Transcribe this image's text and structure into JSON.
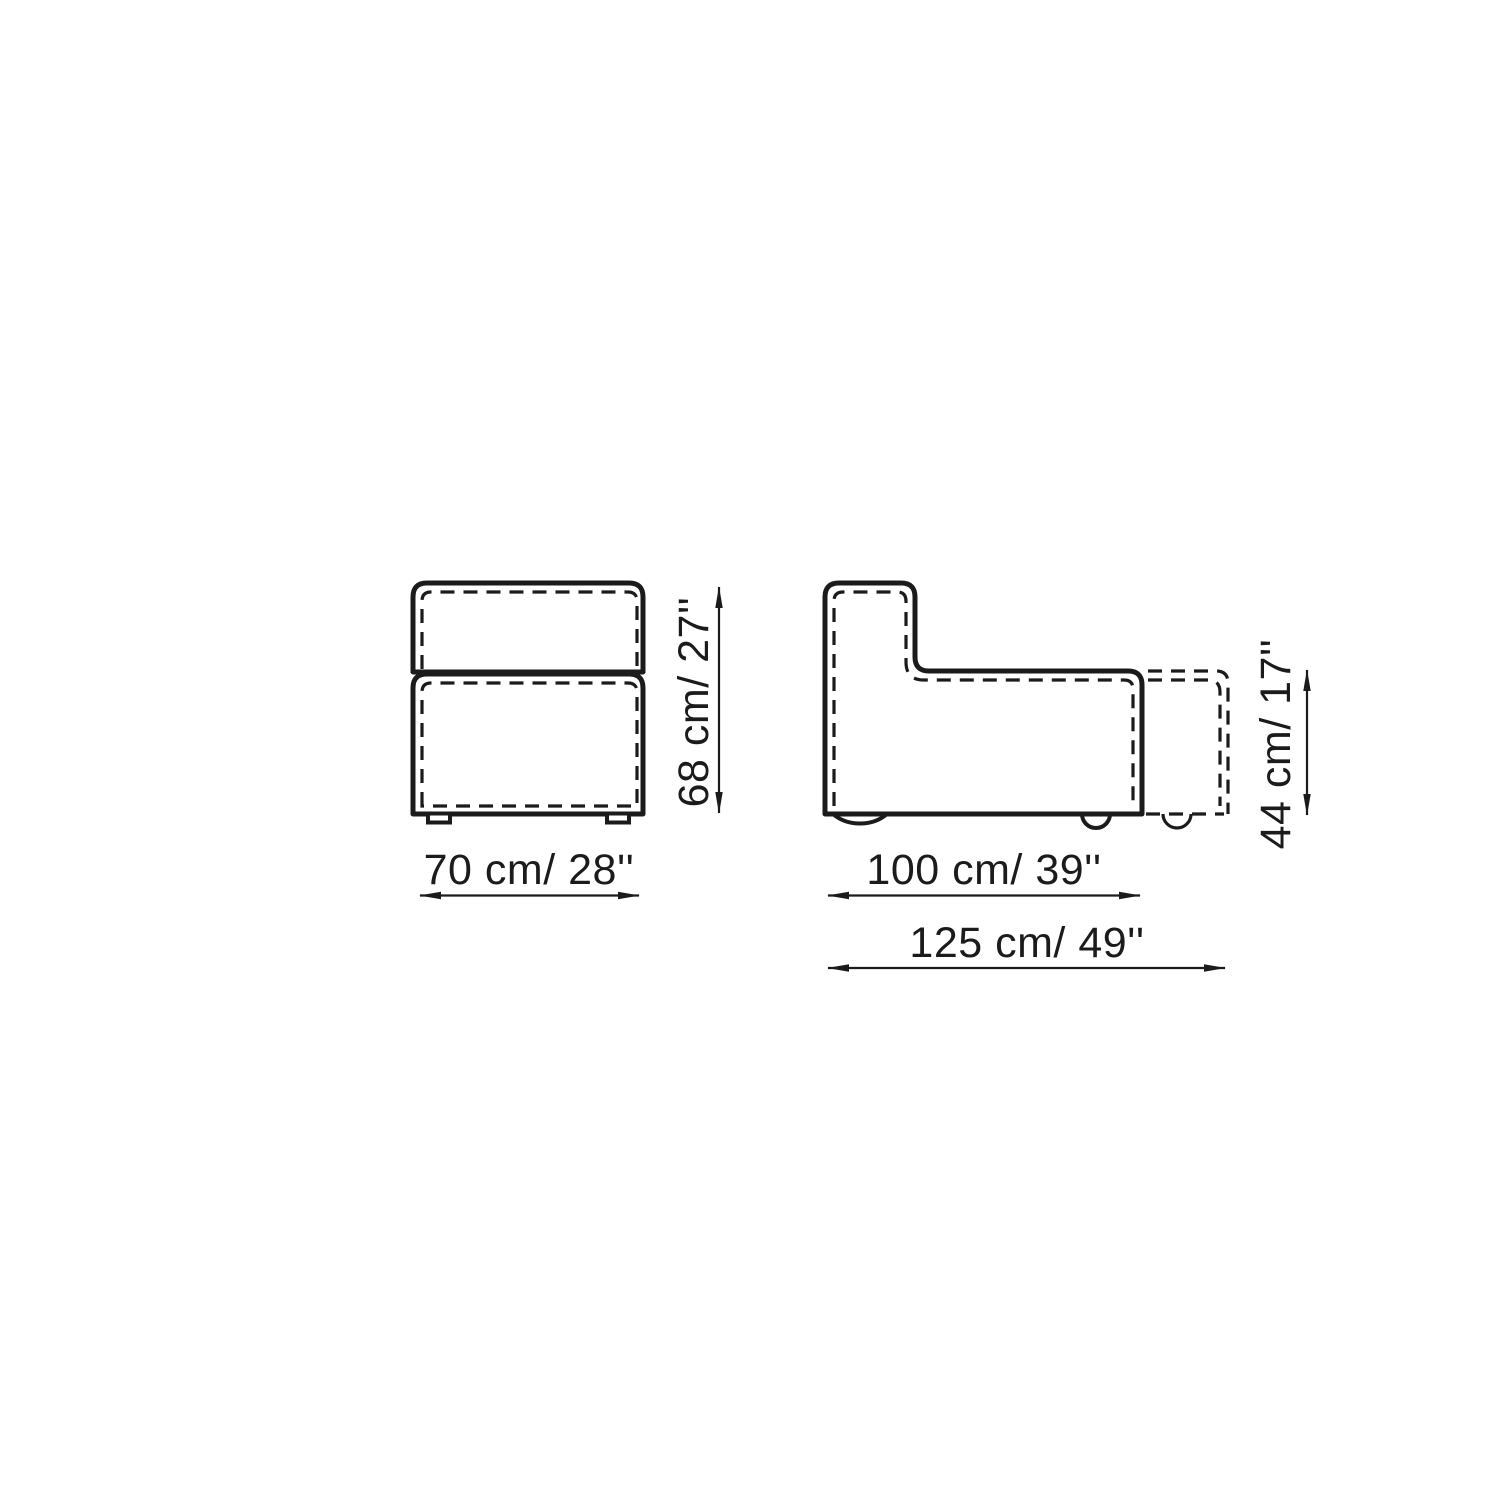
{
  "colors": {
    "line": "#1b1b1b",
    "background": "#ffffff"
  },
  "drawing": {
    "type": "furniture-dimension-drawing",
    "views": [
      "front",
      "side"
    ]
  },
  "dims": {
    "front_width": "70 cm/ 28''",
    "front_height": "68 cm/ 27''",
    "side_seat_depth": "100 cm/ 39''",
    "side_overall_depth": "125 cm/ 49''",
    "side_seat_height": "44 cm/ 17''"
  }
}
